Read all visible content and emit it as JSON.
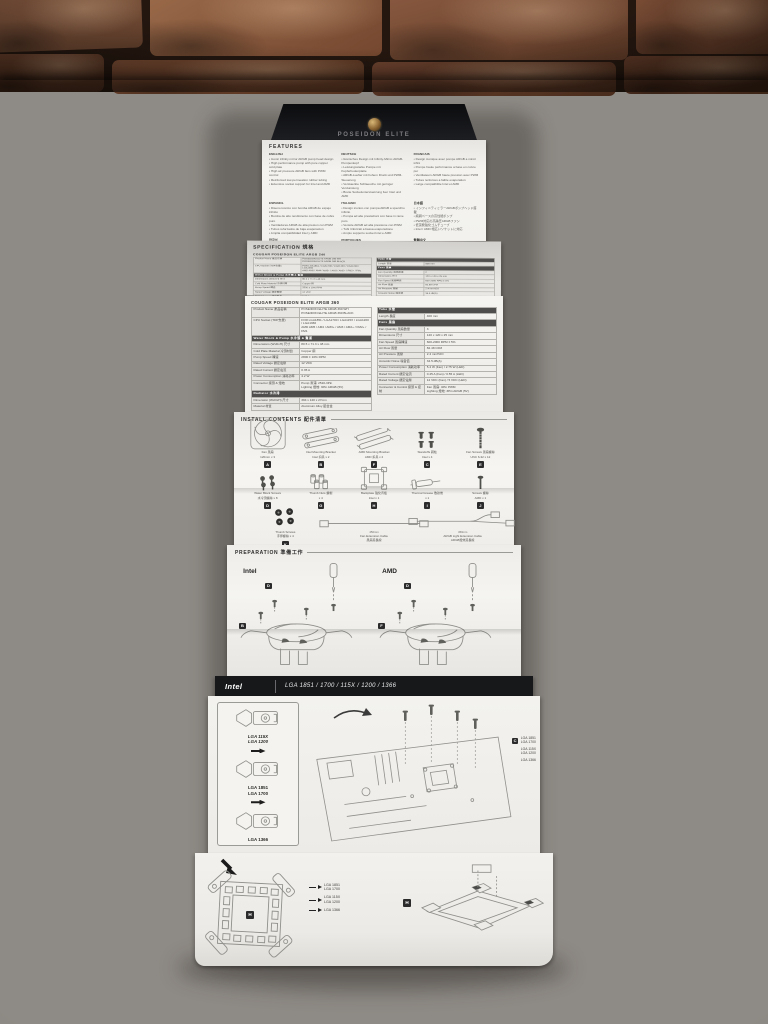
{
  "colors": {
    "paper": "#f2f1ed",
    "black_header": "#17181a",
    "badge_bg": "#2b2b2b",
    "section_header_bg": "#4f4e4c",
    "table_border": "#b5b3ae",
    "label_cell_bg": "#e8e6e2",
    "brick": "#8a5a3e",
    "fabric": "#8e8a85",
    "sketch_line": "#8f8f8b"
  },
  "manual": {
    "cover_title": "POSEIDON ELITE",
    "features": {
      "heading": "FEATURES",
      "blocks": [
        {
          "lang": "ENGLISH",
          "bullets": [
            "Iconic infinity mirror ARGB pump head design",
            "High performance pump with pure copper cold plate",
            "High air pressure ARGB fans with PWM control",
            "Reinforced low-permeation rubber tubing",
            "Extensive socket support for Intel and AMD"
          ]
        },
        {
          "lang": "DEUTSCH",
          "bullets": [
            "Ikonisches Design mit Infinity-Mirror-ARGB-Pumpenkopf",
            "Leistungsstarke Pumpe mit Kupferbodenplatte",
            "ARGB-Luefter mit hohem Druck und PWM-Steuerung",
            "Verstaerkte Schlaeuche mit geringer Verdunstung",
            "Breite Sockelunterstuetzung fuer Intel und AMD"
          ]
        },
        {
          "lang": "FRANCAIS",
          "bullets": [
            "Design iconique avec pompe ARGB a miroir infini",
            "Pompe haute performance a base en cuivre pur",
            "Ventilateurs ARGB haute pression avec PWM",
            "Tubes renforces a faible evaporation",
            "Large compatibilite Intel et AMD"
          ]
        },
        {
          "lang": "ESPANOL",
          "bullets": [
            "Diseno iconico con bomba ARGB de espejo infinito",
            "Bomba de alto rendimiento con base de cobre puro",
            "Ventiladores ARGB de alta presion con PWM",
            "Tubos reforzados de baja evaporacion",
            "Amplia compatibilidad Intel y AMD"
          ]
        },
        {
          "lang": "ITALIANO",
          "bullets": [
            "Design iconico con pompa ARGB a specchio infinito",
            "Pompa ad alte prestazioni con base in rame puro",
            "Ventole ARGB ad alta pressione con PWM",
            "Tubi rinforzati a bassa evaporazione",
            "Ampio supporto socket Intel e AMD"
          ]
        },
        {
          "lang": "日本語",
          "bullets": [
            "インフィニティミラーARGBポンプヘッド搭載",
            "純銅ベースの高性能ポンプ",
            "PWM対応の高静圧ARGBファン",
            "低蒸発強化ゴムチューブ",
            "Intel / AMD 幅広いソケットに対応"
          ]
        },
        {
          "lang": "한국어",
          "bullets": [
            "인피니티 미러 ARGB 펌프 헤드 디자인",
            "순동 베이스 고성능 펌프",
            "PWM 제어 고풍압 ARGB 팬",
            "강화 저증발 고무 튜브",
            "인텔 / AMD 폭넓은 소켓 지원"
          ]
        },
        {
          "lang": "PORTUGUES",
          "bullets": [
            "Design iconico com bomba ARGB de espelho infinito",
            "Bomba de alto desempenho com base de cobre puro",
            "Ventoinhas ARGB de alta pressao com PWM",
            "Tubos reforcados de baixa evaporacao",
            "Ampla compatibilidade Intel e AMD"
          ]
        },
        {
          "lang": "繁體中文",
          "bullets": [
            "無限鏡面 ARGB 幫浦頭設計",
            "高效能幫浦搭配純銅底座",
            "支援 PWM 的高風壓 ARGB 風扇",
            "強化低蒸發橡膠水管",
            "廣泛支援 Intel 與 AMD 平台"
          ]
        }
      ]
    },
    "specification": {
      "heading": "SPECIFICATION 規格"
    },
    "spec240": {
      "title": "COUGAR POSEIDON ELITE ARGB 240",
      "left_rows": [
        {
          "l": "Product Name 產品名稱",
          "v": [
            "POSEIDON ELITE ARGB 240 WH",
            "POSEIDON ELITE ARGB 240 BLACK"
          ]
        },
        {
          "l": "CPU Socket (TDP支援)",
          "v": [
            "FOR LGA1851 / LGA1700 / LGA115X / LGA1200 / LGA1366",
            "AMD AM5 / AM4 / AM3+ / AM3 / AM2+ / FM2+ / FM1"
          ]
        },
        {
          "s": "Water Block & Pump 水冷頭 & 幫浦"
        },
        {
          "l": "Dimensions (WxDxH) 尺寸",
          "v": [
            "80.5 x 71.3 x 48 mm"
          ]
        },
        {
          "l": "Cold Plate Material 冷頭材質",
          "v": [
            "Copper 銅"
          ]
        },
        {
          "l": "Pump Speed 轉速",
          "v": [
            "2800 ± 10% RPM"
          ]
        },
        {
          "l": "Rated Voltage 額定電壓",
          "v": [
            "12 VDC"
          ]
        },
        {
          "l": "Rated Current 額定電流",
          "v": [
            "0.35 A"
          ]
        },
        {
          "l": "Power Consumption 消耗功率",
          "v": [
            "4.2 W"
          ]
        },
        {
          "s": "Radiator 水冷排"
        },
        {
          "l": "Dimension (WxDxH) 尺寸",
          "v": [
            "274 x 120 x 27mm"
          ]
        },
        {
          "l": "Material 材質",
          "v": [
            "Aluminum Alloy 鋁合金"
          ]
        }
      ],
      "right_rows": [
        {
          "s": "Tube 水管"
        },
        {
          "l": "Length 長度",
          "v": [
            "400 mm"
          ]
        },
        {
          "s": "Fans 風扇"
        },
        {
          "l": "Fan Quantity 風扇數量",
          "v": [
            "2"
          ]
        },
        {
          "l": "Dimensions 尺寸",
          "v": [
            "120 x 120 x 25 mm"
          ]
        },
        {
          "l": "Fan Speed 風扇轉速",
          "v": [
            "600-2000 RPM ± 5%"
          ]
        },
        {
          "l": "Air Flow 風量",
          "v": [
            "82.48 CFM"
          ]
        },
        {
          "l": "Air Pressure 風壓",
          "v": [
            "2.4 mmH2O"
          ]
        },
        {
          "l": "Acoustic Noise 噪音值",
          "v": [
            "34.5 dB(A)"
          ]
        },
        {
          "l": "Rated Voltage 額定電壓",
          "v": [
            "12 VDC (Fan) / 5 VDC (LED)"
          ]
        },
        {
          "l": "Connector & Control 接頭 & 控制",
          "v": [
            "Fan 風扇: 4Pin PWM",
            "Lighting 燈效: 3Pin ARGB (5V)"
          ]
        }
      ],
      "footnote": ""
    },
    "spec360": {
      "title": "COUGAR POSEIDON ELITE ARGB 360",
      "left_rows": [
        {
          "l": "Product Name 產品名稱",
          "v": [
            "POSEIDON ELITE ARGB 360 WH",
            "POSEIDON ELITE ARGB 360 BLACK"
          ]
        },
        {
          "l": "CPU Socket (TDP支援)",
          "v": [
            "FOR LGA1851 / LGA1700 / LGA115X / LGA1200 / LGA1366",
            "AMD AM5 / AM4 / AM3+ / AM3 / AM2+ / FM2+ / FM1"
          ]
        },
        {
          "s": "Water Block & Pump 水冷頭 & 幫浦"
        },
        {
          "l": "Dimensions (WxDxH) 尺寸",
          "v": [
            "80.5 x 71.3 x 48 mm"
          ]
        },
        {
          "l": "Cold Plate Material 冷頭材質",
          "v": [
            "Copper 銅"
          ]
        },
        {
          "l": "Pump Speed 轉速",
          "v": [
            "2800 ± 10% RPM"
          ]
        },
        {
          "l": "Rated Voltage 額定電壓",
          "v": [
            "12 VDC"
          ]
        },
        {
          "l": "Rated Current 額定電流",
          "v": [
            "0.35 A"
          ]
        },
        {
          "l": "Power Consumption 消耗功率",
          "v": [
            "4.2 W"
          ]
        },
        {
          "l": "Connector 接頭 & 燈效",
          "v": [
            "Pump 幫浦: 2510-3Pin",
            "Lighting 燈效: 3Pin ARGB (5V)"
          ]
        },
        {
          "s": "Radiator 水冷排"
        },
        {
          "l": "Dimension (WxDxH) 尺寸",
          "v": [
            "394 x 120 x 27mm"
          ]
        },
        {
          "l": "Material 材質",
          "v": [
            "Aluminum Alloy 鋁合金"
          ]
        }
      ],
      "right_rows": [
        {
          "s": "Tube 水管"
        },
        {
          "l": "Length 長度",
          "v": [
            "400 mm"
          ]
        },
        {
          "s": "Fans 風扇"
        },
        {
          "l": "Fan Quantity 風扇數量",
          "v": [
            "3"
          ]
        },
        {
          "l": "Dimensions 尺寸",
          "v": [
            "120 x 120 x 25 mm"
          ]
        },
        {
          "l": "Fan Speed 風扇轉速",
          "v": [
            "600-2000 RPM ± 5%"
          ]
        },
        {
          "l": "Air Flow 風量",
          "v": [
            "82.48 CFM"
          ]
        },
        {
          "l": "Air Pressure 風壓",
          "v": [
            "2.4 mmH2O"
          ]
        },
        {
          "l": "Acoustic Noise 噪音值",
          "v": [
            "34.5 dB(A)"
          ]
        },
        {
          "l": "Power Consumption 消耗功率",
          "v": [
            "5.4 W (Fan) / 2.75 W (LED)"
          ]
        },
        {
          "l": "Rated Current 額定電流",
          "v": [
            "0.45 A (Fan) / 0.55 A (LED)"
          ]
        },
        {
          "l": "Rated Voltage 額定電壓",
          "v": [
            "12 VDC (Fan) / 5 VDC (LED)"
          ]
        },
        {
          "l": "Connector & Control 接頭 & 控制",
          "v": [
            "Fan 風扇: 4Pin PWM",
            "Lighting 燈效: 3Pin ARGB (5V)"
          ]
        }
      ],
      "footnote": "All specifications are subject to change without notice 本規格如有變更，恕不另行通知"
    },
    "install": {
      "heading": "INSTALL CONTENTS 配件清單",
      "rows": [
        [
          {
            "badge": "A",
            "icon": "fan",
            "label": "Fan 風扇",
            "sub": "120mm x 3"
          },
          {
            "badge": "B",
            "icon": "bracket",
            "label": "Intel Mounting Bracket",
            "sub": "Intel 扣具 x 2"
          },
          {
            "badge": "F",
            "icon": "bracket2",
            "label": "AMD Mounting Bracket",
            "sub": "AMD 扣具 x 2"
          },
          {
            "badge": "C",
            "icon": "standoffs",
            "label": "Standoffs 銅柱",
            "sub": "Intel x 4"
          },
          {
            "badge": "E",
            "icon": "fanscrew",
            "label": "Fan Screws 風扇螺絲",
            "sub": "UNC 6-32 x 12"
          }
        ],
        [
          {
            "badge": "D",
            "icon": "blockscrews",
            "label": "Water Block Screws",
            "sub": "水冷頭螺絲 x 8"
          },
          {
            "badge": "G",
            "icon": "nuts",
            "label": "Thumb Nuts 螺帽",
            "sub": "x 4"
          },
          {
            "badge": "H",
            "icon": "backplate",
            "label": "Backplate 強化背板",
            "sub": "Intel x 1"
          },
          {
            "badge": "I",
            "icon": "thermal",
            "label": "Thermal Grease 散熱膏",
            "sub": "x 1"
          },
          {
            "badge": "J",
            "icon": "screwsmall",
            "label": "Screws 螺絲",
            "sub": "AMD x 1"
          }
        ],
        [
          {
            "badge": "K",
            "icon": "thumbscrews",
            "label": "Thumb Screws",
            "sub": "手擰螺絲 x 4"
          },
          {
            "badge": "L",
            "icon": "cable",
            "label": "Fan Extension Cable",
            "sub": "風扇延長線",
            "len": "450mm"
          },
          {
            "badge": "M",
            "icon": "cableargb",
            "label": "ARGB Light Extension Cable",
            "sub": "ARGB燈效延長線",
            "len": "450mm"
          }
        ]
      ]
    },
    "preparation": {
      "heading": "PREPARATION 準備工作",
      "platforms": [
        {
          "name": "Intel",
          "bracket_badge": "B",
          "screw_badge": "D"
        },
        {
          "name": "AMD",
          "bracket_badge": "F",
          "screw_badge": "D"
        }
      ]
    },
    "intel_bar": {
      "brand": "Intel",
      "sockets": "LGA 1851 / 1700 / 115X / 1200 / 1366"
    },
    "intel_install": {
      "bracket_steps": [
        {
          "lines": [
            "LGA 115X",
            "LGA 1200"
          ],
          "bold": true
        },
        {
          "lines": [
            "LGA 1851",
            "LGA 1700"
          ],
          "bold": false
        },
        {
          "lines": [
            "LGA 1366"
          ],
          "bold": false
        }
      ],
      "standoff_callout": {
        "badge": "C",
        "lines": [
          "LGA 1851",
          "LGA 1700",
          "LGA 115X",
          "LGA 1200",
          "LGA 1366"
        ]
      },
      "backplate": {
        "badge": "H",
        "entries": [
          [
            "LGA 1851",
            "LGA 1700"
          ],
          [
            "LGA 115X",
            "LGA 1200"
          ],
          [
            "LGA 1366"
          ]
        ]
      }
    }
  }
}
